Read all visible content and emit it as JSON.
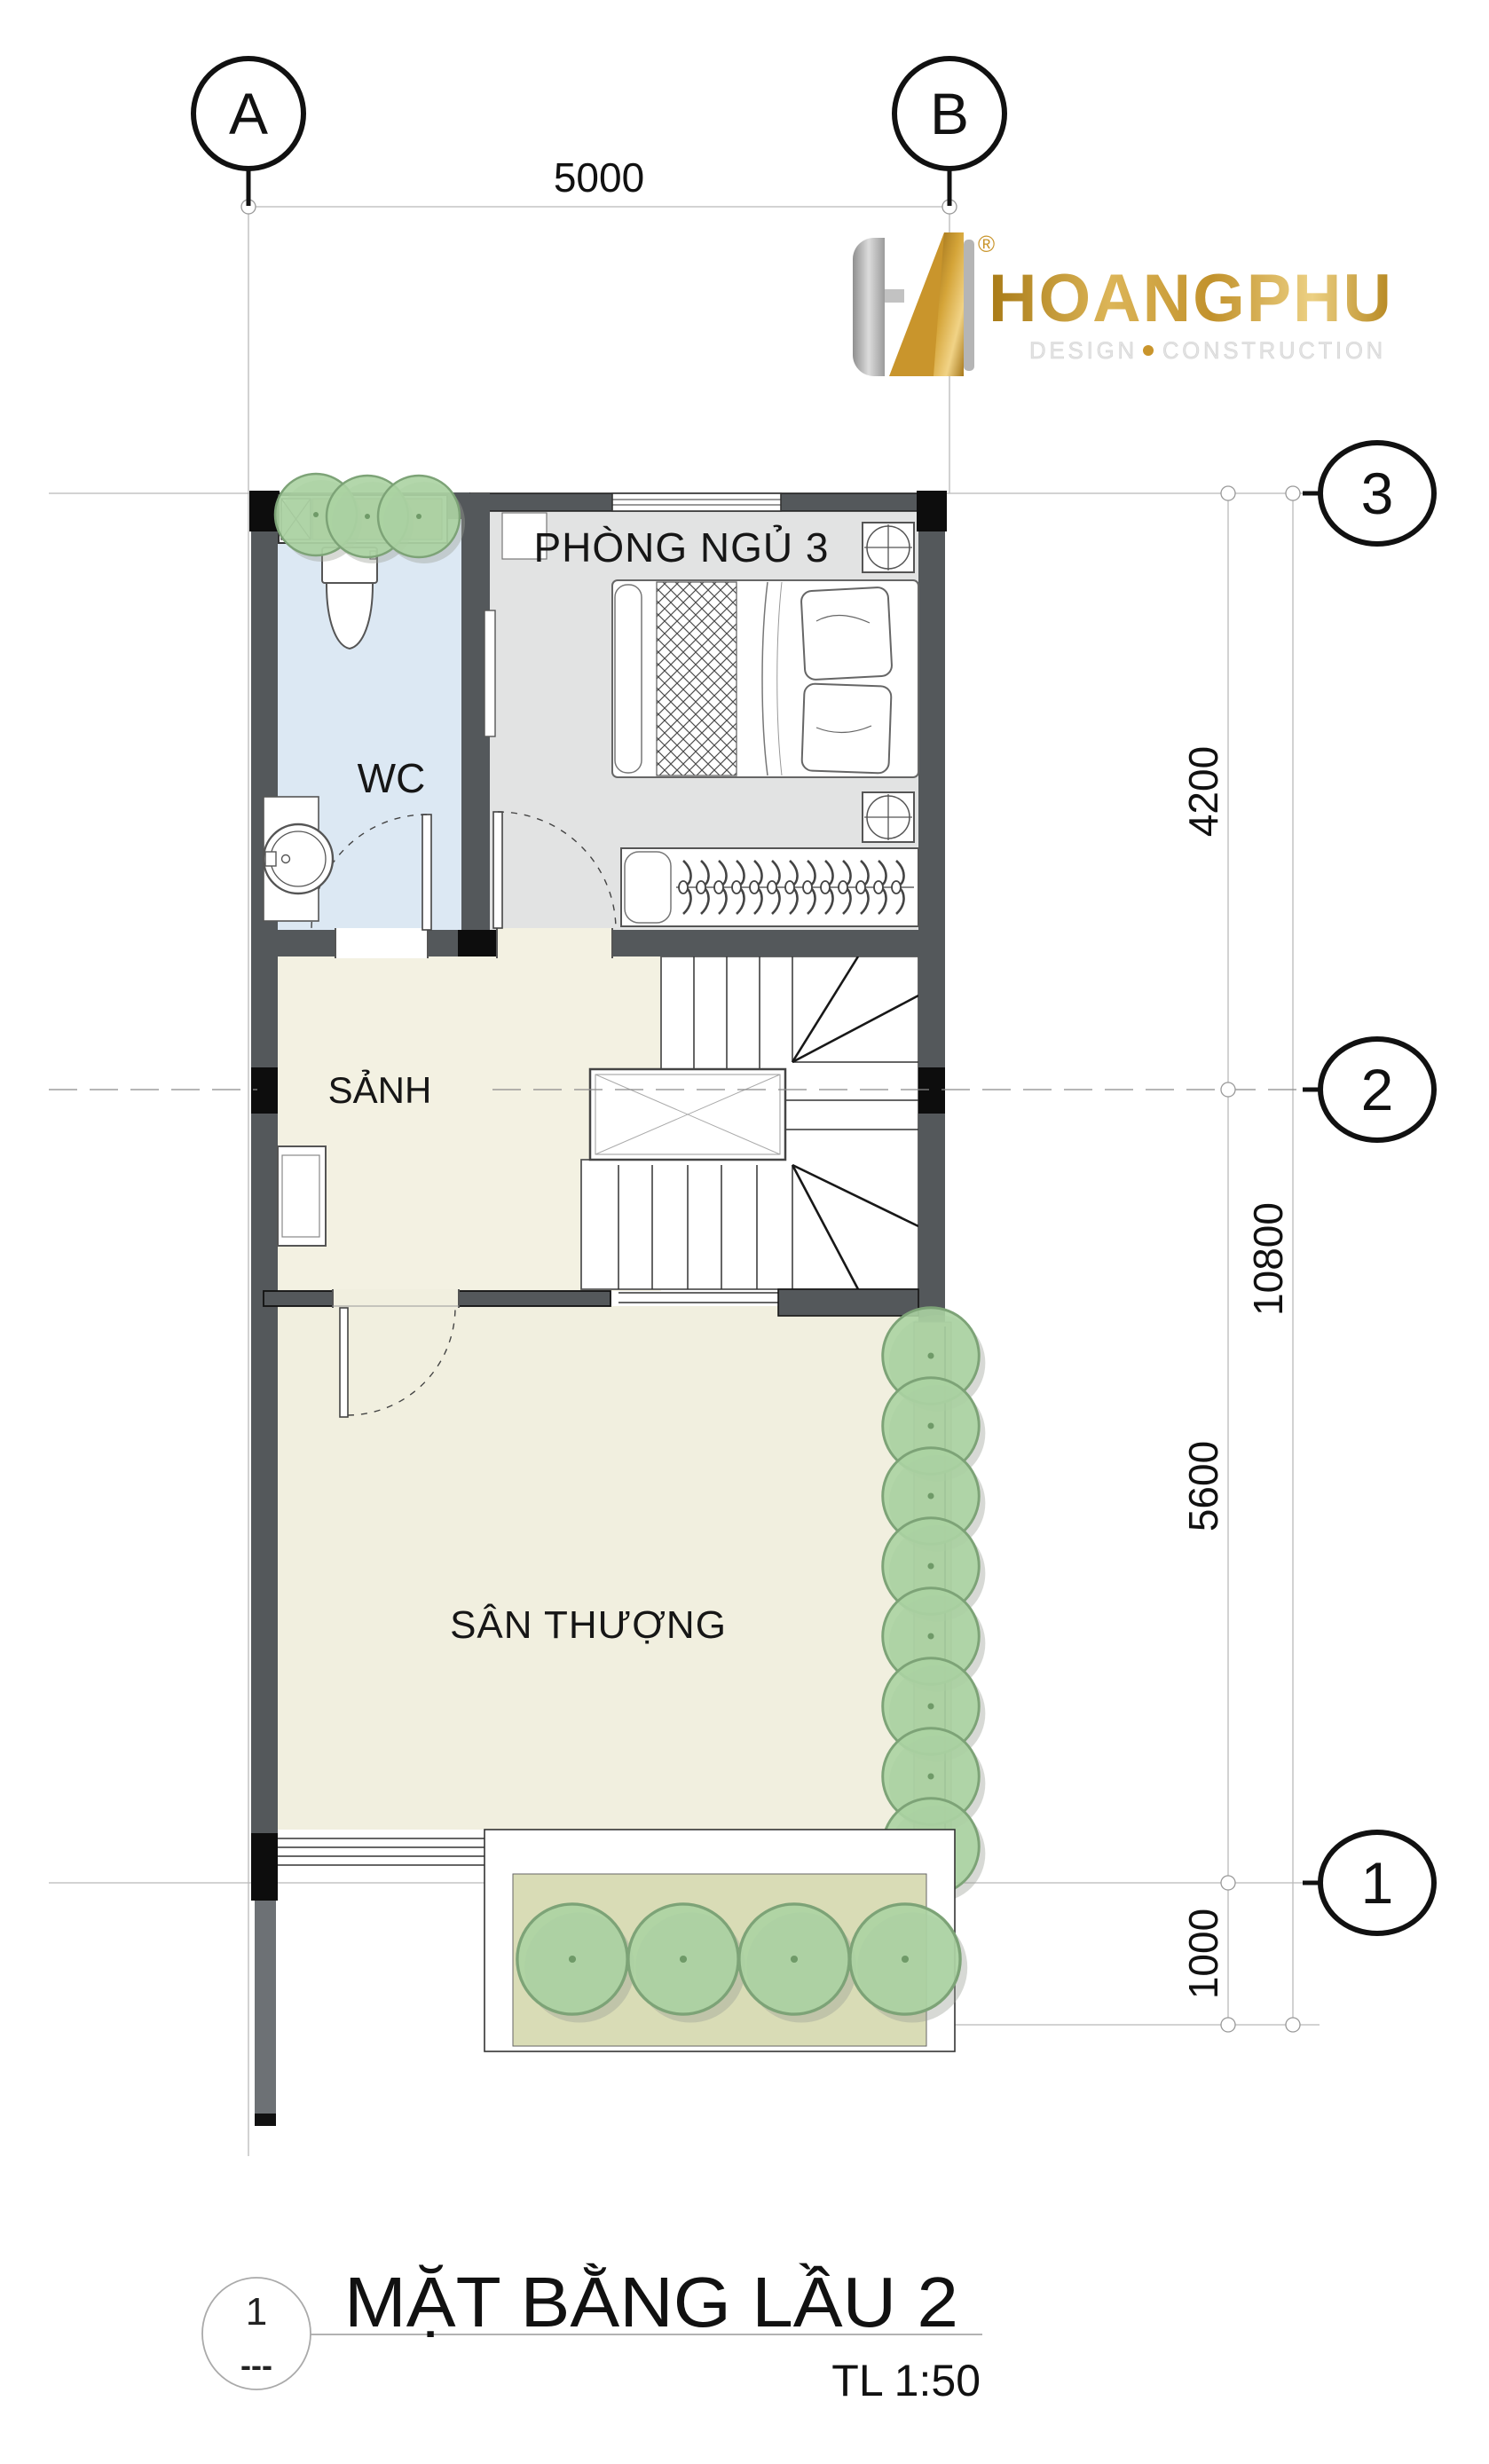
{
  "logo": {
    "brand": "HOANGPHU",
    "registered": "®",
    "tagline_left": "DESIGN",
    "tagline_right": "CONSTRUCTION",
    "gold": "#c9952c"
  },
  "grid": {
    "col_a": "A",
    "col_b": "B",
    "row_3": "3",
    "row_2": "2",
    "row_1": "1"
  },
  "dimensions": {
    "top_width": "5000",
    "seg_3_2": "4200",
    "seg_2_1": "5600",
    "seg_below_1": "1000",
    "overall": "10800"
  },
  "rooms": {
    "wc": "WC",
    "bedroom": "PHÒNG NGỦ 3",
    "hall": "SẢNH",
    "terrace": "SÂN THƯỢNG"
  },
  "titleblock": {
    "ref_number": "1",
    "ref_sub": "---",
    "title": "MẶT BẰNG LẦU 2",
    "scale": "TL 1:50"
  }
}
